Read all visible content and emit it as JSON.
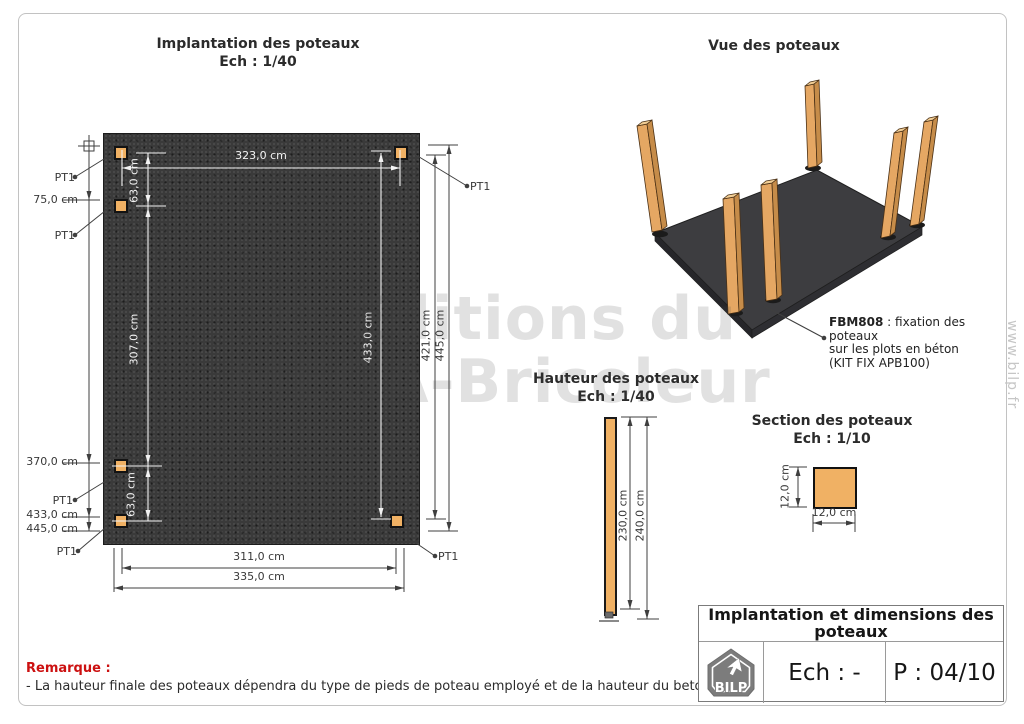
{
  "plan": {
    "title": "Implantation des poteaux",
    "scale": "Ech : 1/40",
    "pt1": "PT1",
    "dims": {
      "d323": "323,0 cm",
      "d63": "63,0 cm",
      "d307": "307,0 cm",
      "d433": "433,0 cm",
      "d75": "75,0 cm",
      "d370": "370,0 cm",
      "d445": "445,0 cm",
      "d421": "421,0 cm",
      "d311": "311,0 cm",
      "d335": "335,0 cm"
    }
  },
  "view3d": {
    "title": "Vue des poteaux",
    "note_code": "FBM808",
    "note_rest": " : fixation des poteaux",
    "note_line2": "sur les plots en béton",
    "note_line3": "(KIT FIX APB100)"
  },
  "hauteur": {
    "title": "Hauteur des poteaux",
    "scale": "Ech : 1/40",
    "d230": "230,0 cm",
    "d240": "240,0 cm"
  },
  "section": {
    "title": "Section des poteaux",
    "scale": "Ech : 1/10",
    "d12w": "12,0 cm",
    "d12h": "12,0 cm"
  },
  "remark": {
    "label": "Remarque :",
    "text": "- La hauteur finale des poteaux dépendra du type de pieds de poteau employé et de la hauteur du beton support."
  },
  "titleblock": {
    "title": "Implantation et dimensions des poteaux",
    "logo_text": "BILP",
    "scale": "Ech : -",
    "page_num": "P : 04/10"
  },
  "watermark": {
    "line1": "© Editions du",
    "line2": "MEGA-Bricoleur",
    "side": "www.bilp.fr"
  },
  "colors": {
    "post_fill": "#f0b164",
    "slab_fill": "#3a3a3a",
    "remark_red": "#cc1111",
    "logo_gray": "#7c7c7c",
    "dim_line_dark": "#3f3f3f",
    "dim_line_white": "#f2f2f2"
  }
}
